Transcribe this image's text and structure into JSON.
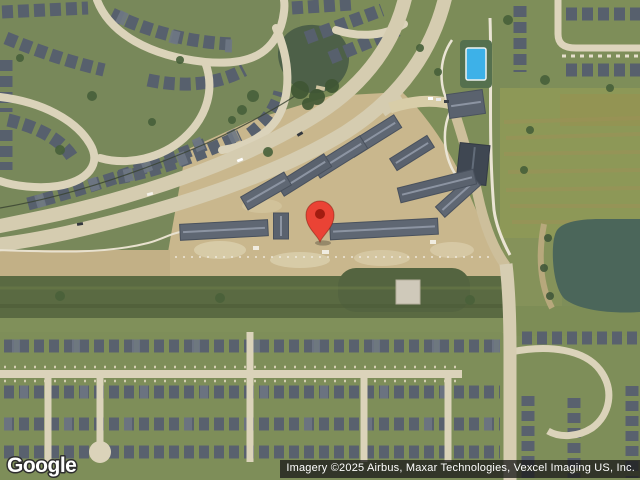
{
  "map": {
    "view_type": "satellite",
    "marker": {
      "pin_color": "#EA4335",
      "pin_dot_color": "#A21C10"
    },
    "palette": {
      "grass": "#7e8e59",
      "field": "#8d9857",
      "construction_dirt": "#c9b78d",
      "main_road": "#d5ccb0",
      "street": "#dbd3ba",
      "roof": "#57606d",
      "canal_water": "#5a6a42",
      "pond_water": "#4c6048",
      "lake_water": "#4b665a",
      "pool_water": "#3db1e8"
    }
  },
  "watermark": {
    "logo_text": "Google"
  },
  "attribution": {
    "text": "Imagery ©2025 Airbus, Maxar Technologies, Vexcel Imaging US, Inc."
  }
}
